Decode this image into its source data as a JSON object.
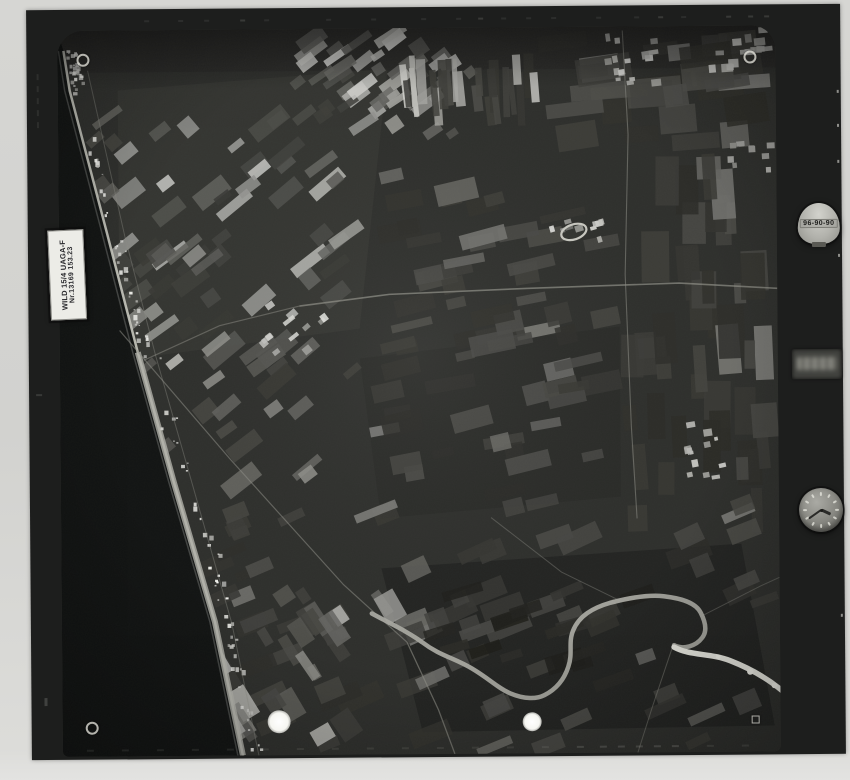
{
  "photo": {
    "description": "black-and-white aerial survey photograph scan",
    "camera_label_line1": "WILD 15/4 UAGA-F",
    "camera_label_line2": "Nr.13169 153.23",
    "frame_counter": "96-90-90"
  },
  "colors": {
    "paper": "#d6d6d3",
    "photo_border": "#1d1e1d",
    "land_base": "#2e2f2c",
    "sea": "#121413",
    "beach": "#c6c6be",
    "beach_wide": "#b2b2aa",
    "road": "#8e8e86",
    "river": "#a8a8a0",
    "river_bright": "#e6e6de",
    "town": "#e2e2da",
    "ring": "#c9c9c1"
  }
}
